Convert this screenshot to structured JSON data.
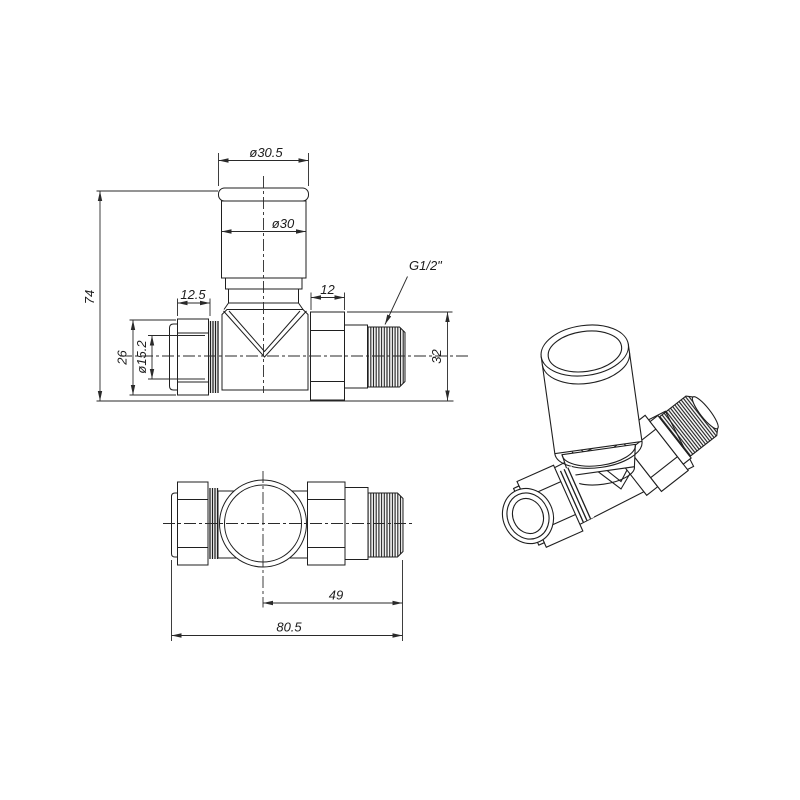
{
  "drawing": {
    "background": "#ffffff",
    "line_color": "#1f1f1f",
    "dim_color": "#2a2a2a",
    "dims": {
      "d305": "ø30.5",
      "d30": "ø30",
      "h74": "74",
      "w125": "12.5",
      "w12": "12",
      "h26": "26",
      "d152": "ø15.2",
      "thread_label": "G1/2\"",
      "h32": "32",
      "w49": "49",
      "w805": "80.5"
    }
  }
}
